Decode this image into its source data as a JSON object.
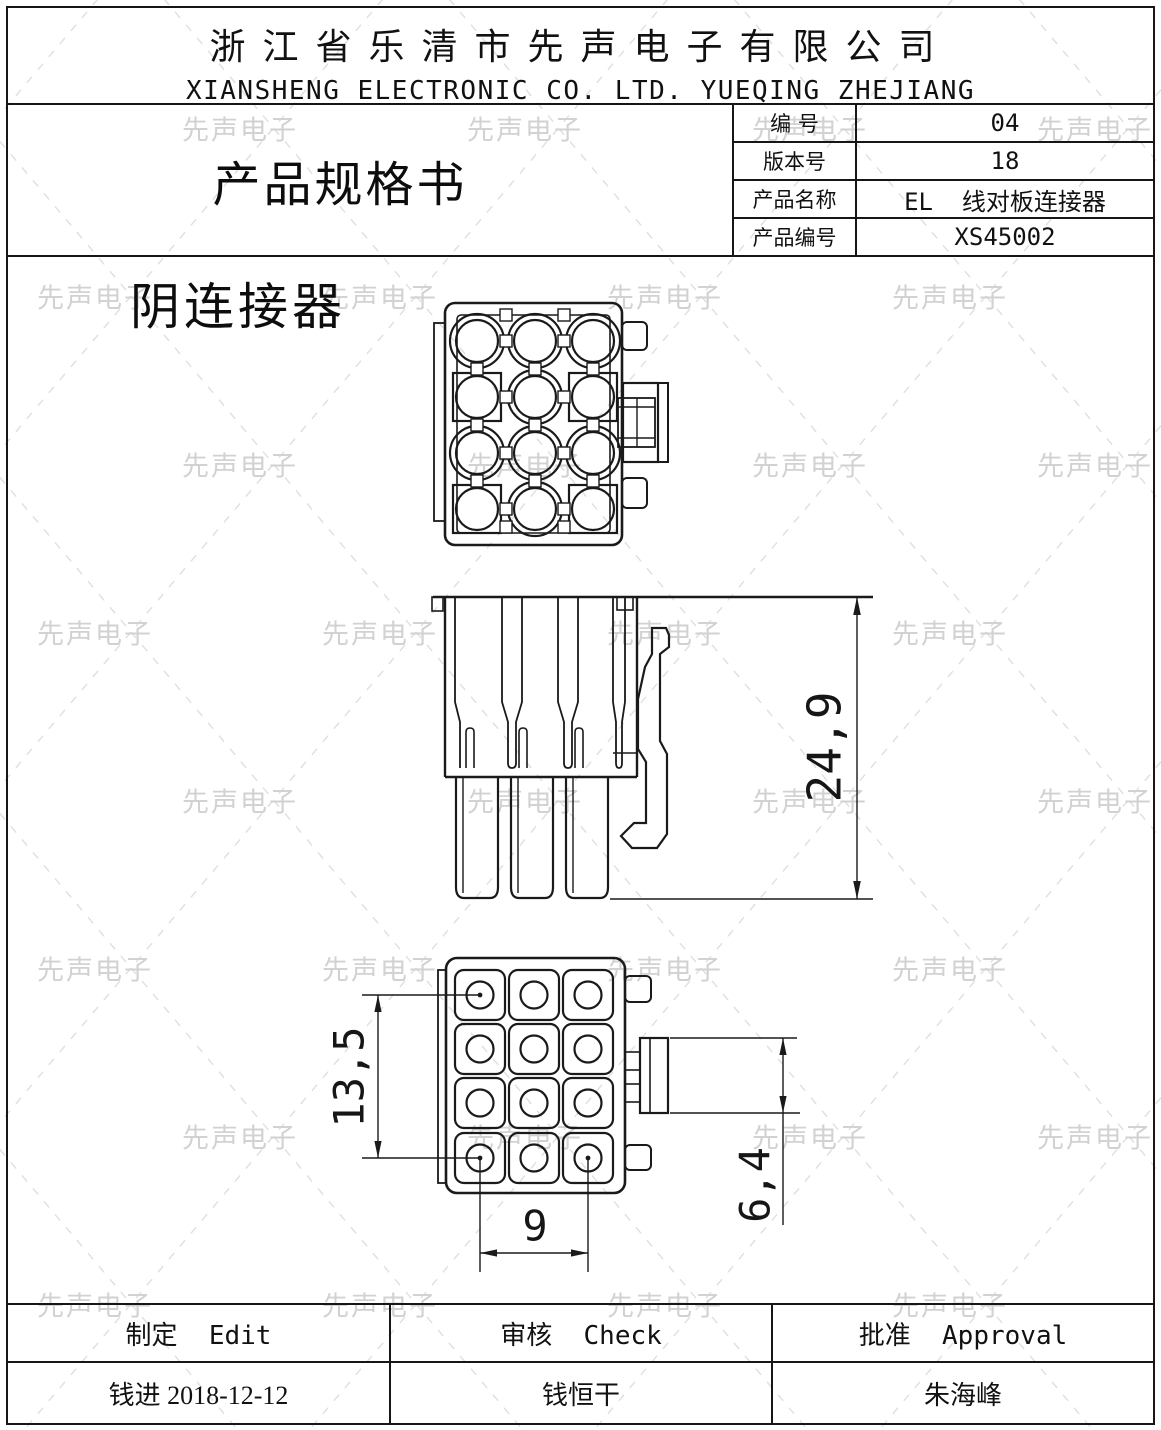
{
  "header": {
    "company_cn": "浙江省乐清市先声电子有限公司",
    "company_en": "XIANSHENG ELECTRONIC CO. LTD. YUEQING ZHEJIANG"
  },
  "title_block": {
    "doc_title": "产品规格书",
    "rows": [
      {
        "label": "编 号",
        "value": "04"
      },
      {
        "label": "版本号",
        "value": "18"
      },
      {
        "label": "产品名称",
        "value": "EL  线对板连接器"
      },
      {
        "label": "产品编号",
        "value": "XS45002"
      }
    ]
  },
  "drawing": {
    "view_label": "阴连接器",
    "dimensions": {
      "height": "24,9",
      "grid_height": "13,5",
      "grid_width": "9",
      "latch_height": "6,4"
    }
  },
  "footer": {
    "columns": [
      {
        "role": "制定  Edit",
        "name": "钱进 2018-12-12"
      },
      {
        "role": "审核  Check",
        "name": "钱恒干"
      },
      {
        "role": "批准  Approval",
        "name": "朱海峰"
      }
    ]
  },
  "watermark": {
    "text": "先声电子",
    "color": "#d2d2d2"
  },
  "colors": {
    "line": "#1a1a1a",
    "border": "#161616"
  }
}
